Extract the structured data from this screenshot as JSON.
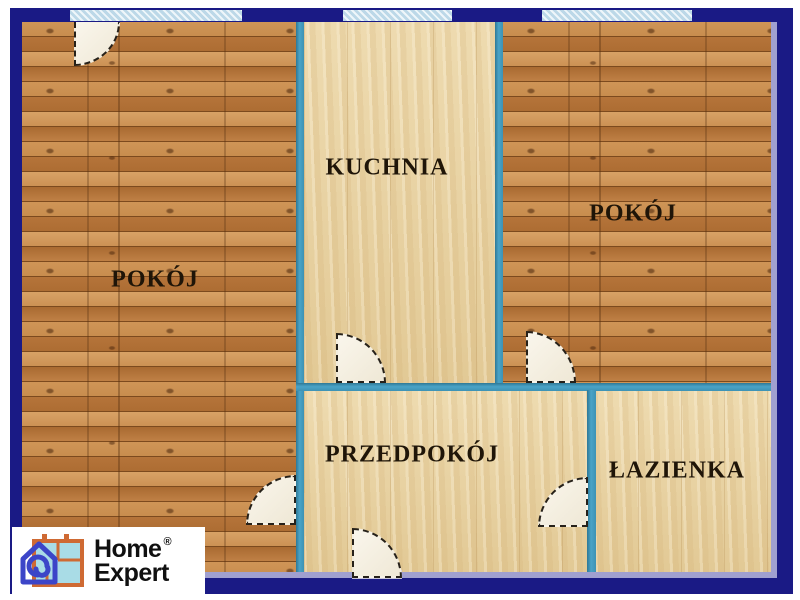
{
  "plan": {
    "type": "apartment-floor-plan",
    "rooms": {
      "pokoj_left": {
        "label": "POKÓJ"
      },
      "kuchnia": {
        "label": "KUCHNIA"
      },
      "pokoj_right": {
        "label": "POKÓJ"
      },
      "przedpokoj": {
        "label": "PRZEDPOKÓJ"
      },
      "lazienka": {
        "label": "ŁAZIENKA"
      }
    },
    "windows": [
      "window-pokoj-left",
      "window-kuchnia",
      "window-pokoj-right"
    ],
    "doors": [
      "door-pokoj-left-balcony",
      "door-kuchnia",
      "door-pokoj-right",
      "door-pokoj-left",
      "door-lazienka",
      "door-entrance"
    ]
  },
  "logo": {
    "line1": "Home",
    "line2": "Expert",
    "registered": "®"
  },
  "colors": {
    "border_navy": "#1a1a85",
    "wall_blue": "#3d92b4",
    "edge_lavender": "#a0a0d0",
    "floor_pine": "#b87a40",
    "floor_maple": "#e9d3a3",
    "label_ink": "#1f1508",
    "logo_orange": "#cf6a33",
    "logo_blue": "#3c45c8",
    "logo_cyan": "#a9dce6"
  }
}
